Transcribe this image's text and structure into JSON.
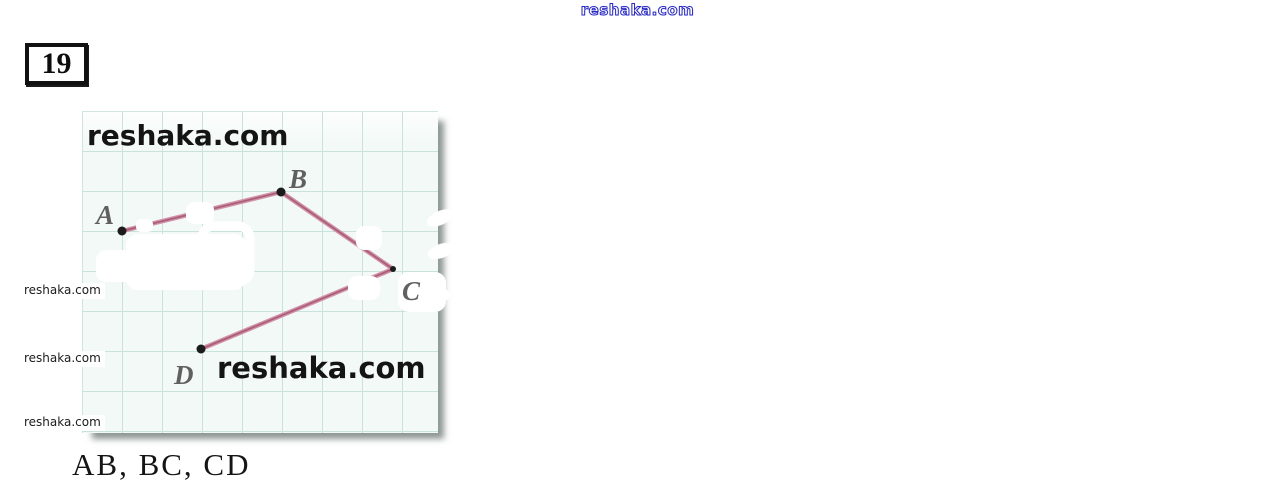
{
  "problem": {
    "number": "19",
    "answer": "AB, BC, CD"
  },
  "watermarks": {
    "top": "reshaka.com",
    "grid_large_1": "reshaka.com",
    "grid_large_2": "reshaka.com",
    "left_small": [
      "reshaka.com",
      "reshaka.com",
      "reshaka.com"
    ]
  },
  "figure": {
    "paper": {
      "x": 82,
      "y": 111,
      "width": 355,
      "height": 321,
      "cell": 40,
      "paper_color": "#f3f9f7",
      "grid_color": "#c9e2de"
    },
    "points": [
      {
        "label": "A",
        "x": 122,
        "y": 231,
        "r": 4.5,
        "label_x": 96,
        "label_y": 224
      },
      {
        "label": "B",
        "x": 281,
        "y": 192,
        "r": 4.5,
        "label_x": 289,
        "label_y": 188
      },
      {
        "label": "C",
        "x": 393,
        "y": 269,
        "r": 3,
        "label_x": 402,
        "label_y": 300
      },
      {
        "label": "D",
        "x": 201,
        "y": 349,
        "r": 4.5,
        "label_x": 174,
        "label_y": 384
      }
    ],
    "segments": [
      {
        "from": "A",
        "to": "B"
      },
      {
        "from": "B",
        "to": "C"
      },
      {
        "from": "C",
        "to": "D"
      }
    ],
    "segment_color": "#d393a9",
    "segment_core_color": "#aa5e7a",
    "dot_color": "#1b1b1b",
    "label_color": "#4c4c4c"
  }
}
